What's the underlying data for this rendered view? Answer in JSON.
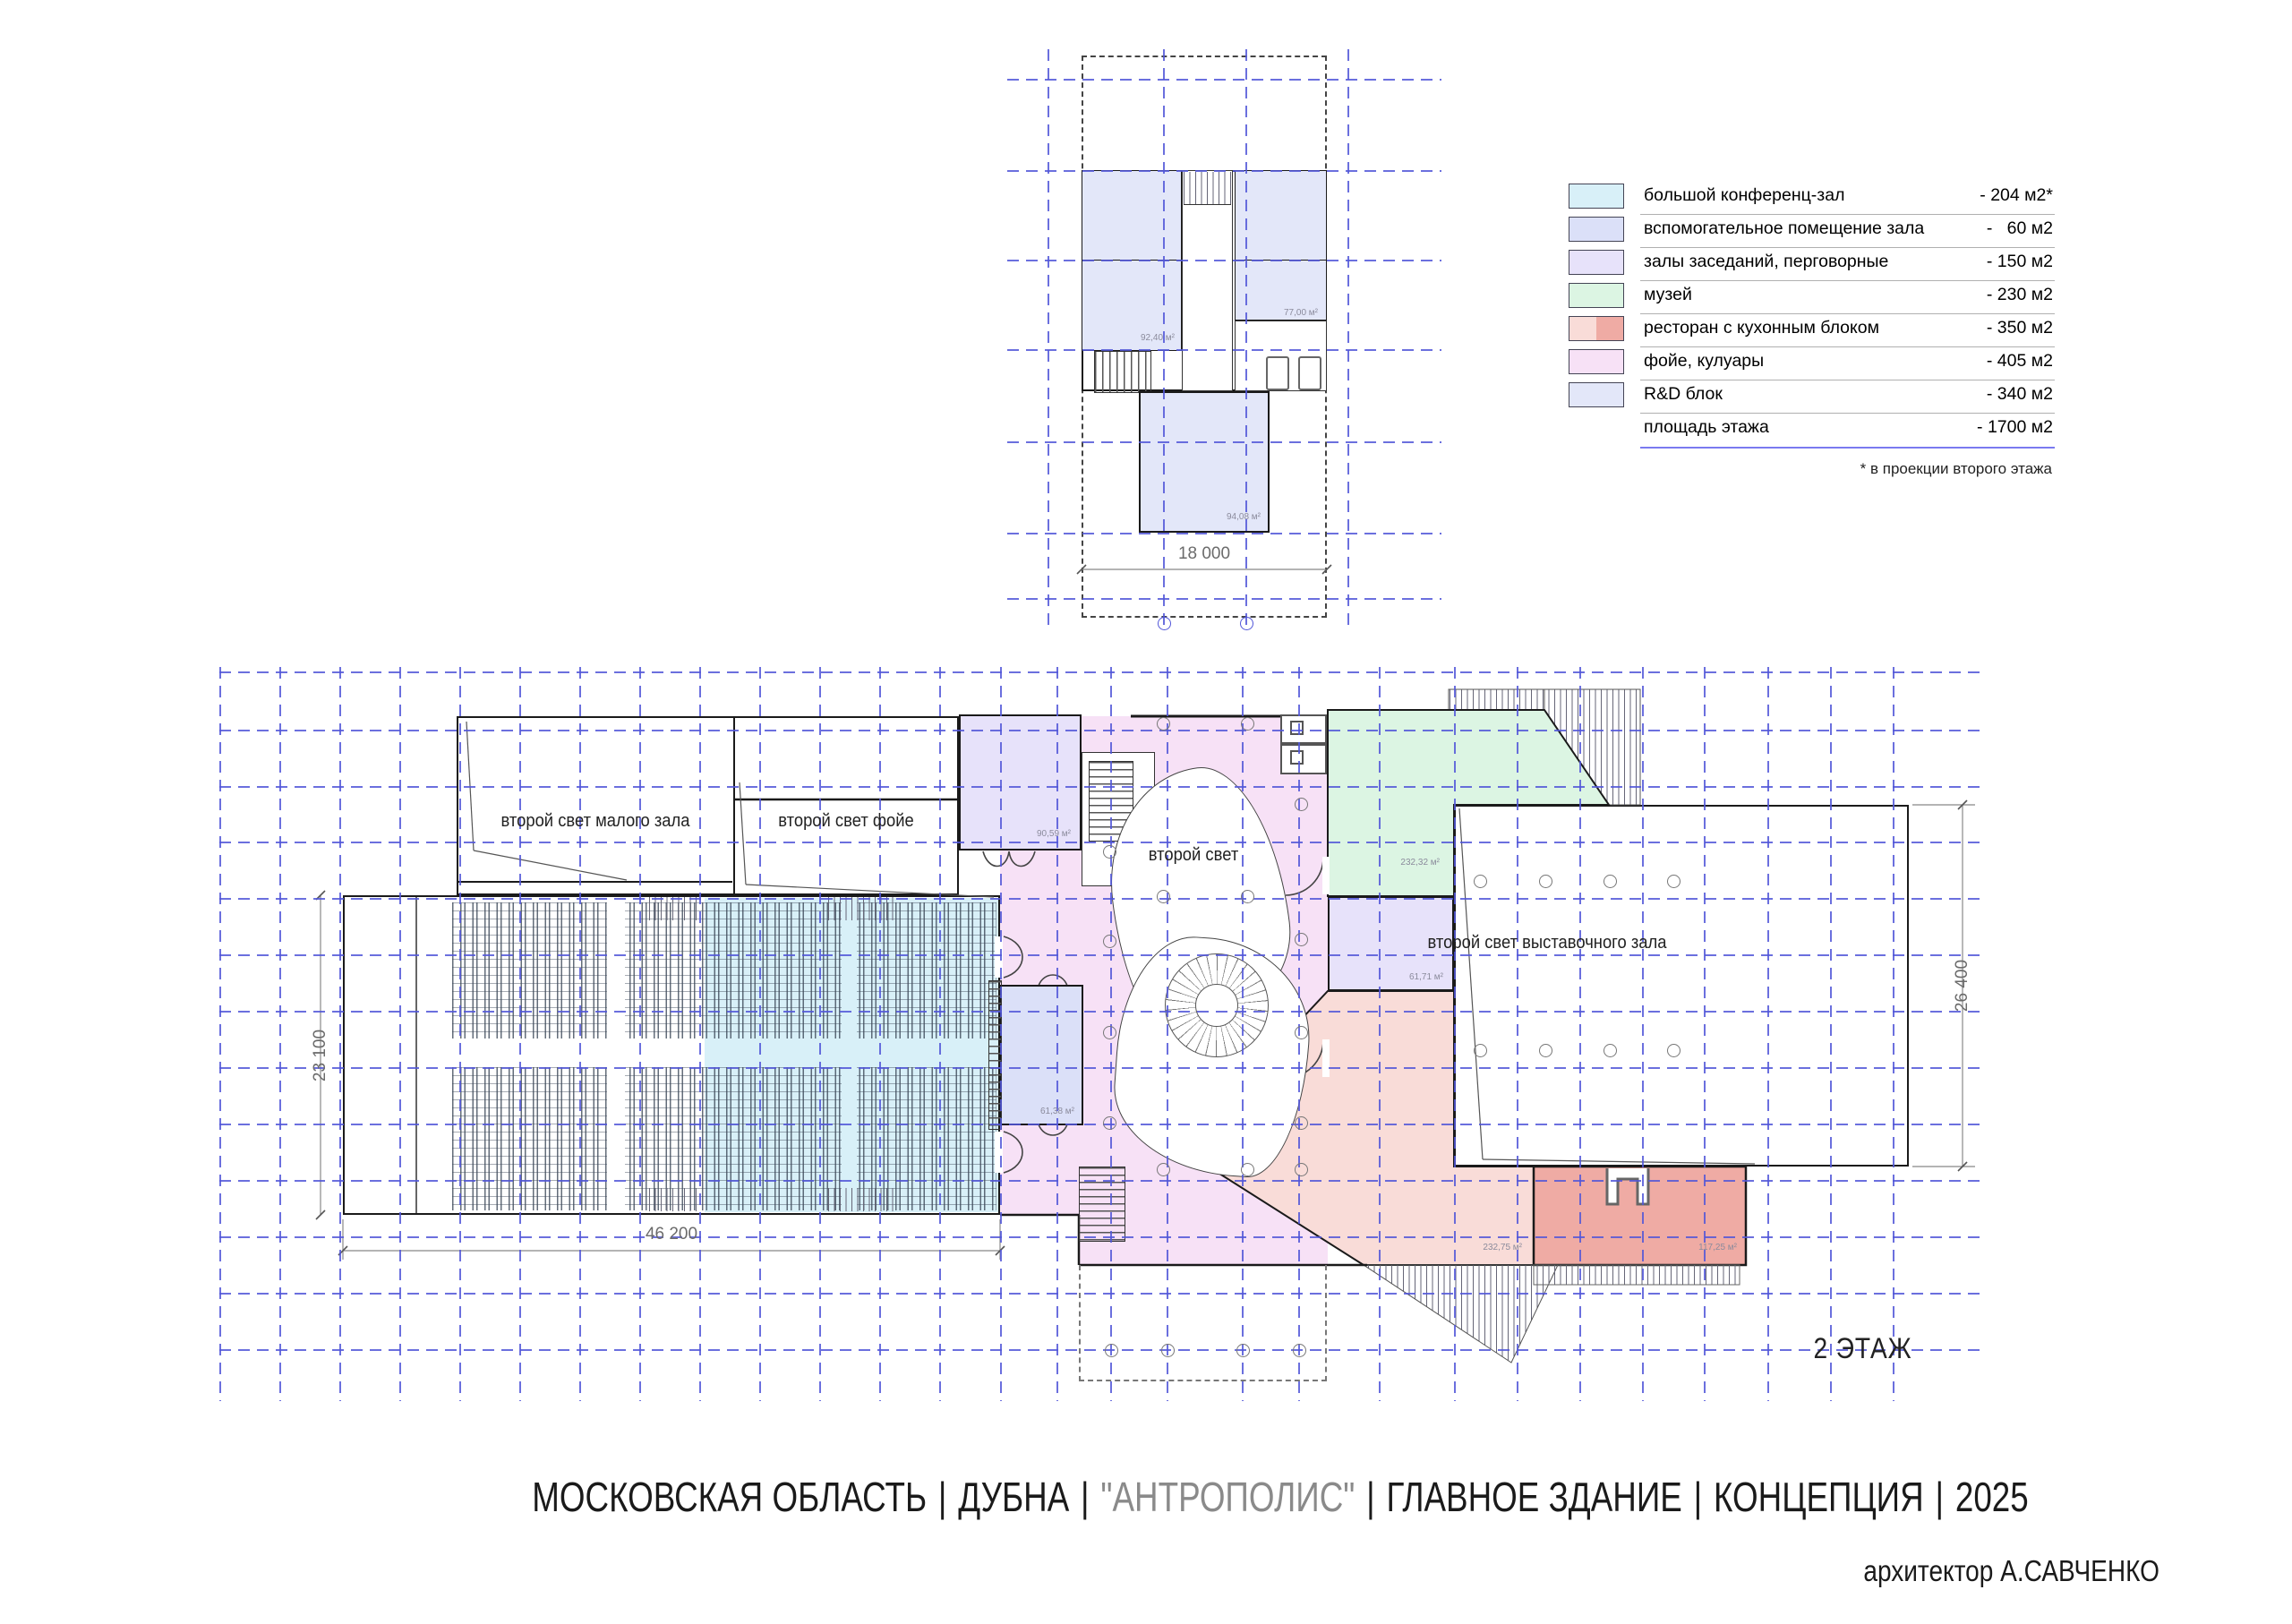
{
  "legend": {
    "items": [
      {
        "label": "большой конференц-зал",
        "value": "- 204 м2*",
        "color": "#d8f0f8"
      },
      {
        "label": "вспомогательное помещение зала",
        "value": "-   60 м2",
        "color": "#dbe0f8"
      },
      {
        "label": "залы заседаний, перговорные",
        "value": "- 150 м2",
        "color": "#e7e2fa"
      },
      {
        "label": "музей",
        "value": "- 230 м2",
        "color": "#dcf5e3"
      },
      {
        "label": "ресторан с кухонным блоком",
        "value": "- 350 м2",
        "color": "#f9dcd8",
        "color2": "#efaba4"
      },
      {
        "label": "фойе, кулуары",
        "value": "- 405 м2",
        "color": "#f7e1f6"
      },
      {
        "label": "R&D блок",
        "value": "- 340 м2",
        "color": "#e3e7f9"
      },
      {
        "label": "площадь этажа",
        "value": "- 1700 м2",
        "color": ""
      }
    ],
    "note": "* в проекции второго этажа"
  },
  "titles": {
    "region": "МОСКОВСКАЯ ОБЛАСТЬ",
    "city": "ДУБНА",
    "project": "\"АНТРОПОЛИС\"",
    "building": "ГЛАВНОЕ ЗДАНИЕ",
    "stage": "КОНЦЕПЦИЯ",
    "year": "2025",
    "sep": "|",
    "credit": "архитектор А.САВЧЕНКО",
    "floor": "2 ЭТАЖ"
  },
  "plan": {
    "labels": {
      "small_hall_void": "второй свет малого зала",
      "foyer_void": "второй свет фойе",
      "atrium_void": "второй свет",
      "exhibition_void": "второй свет выставочного зала"
    },
    "areas": {
      "upper_left_room": "92,40 м²",
      "upper_right_room": "77,00 м²",
      "upper_lower_room": "94,08 м²",
      "meeting_room": "90,59 м²",
      "hall_support_room": "61,38 м²",
      "museum": "232,32 м²",
      "hall_aux_room": "61,71 м²",
      "restaurant": "232,75 м²",
      "kitchen": "117,25 м²"
    },
    "dimensions": {
      "top_plan_width": "18 000",
      "hall_width": "46 200",
      "hall_depth": "23 100",
      "exhibition_depth": "26 400"
    }
  },
  "colors": {
    "grid": "#5156d8",
    "walls": "#1a1a1a",
    "title_muted": "#8a8a8a"
  }
}
